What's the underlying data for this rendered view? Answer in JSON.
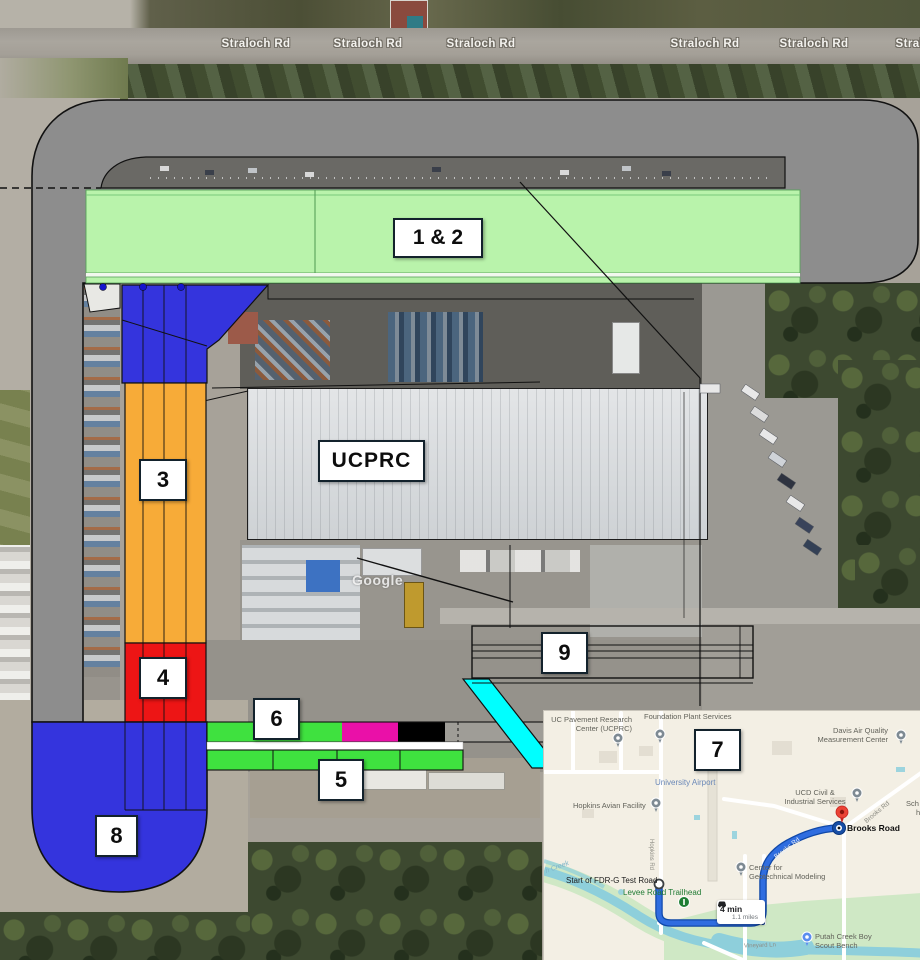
{
  "map_labels": {
    "road_name": "Straloch Rd",
    "road_labels": [
      "Straloch Rd",
      "Straloch Rd",
      "Straloch Rd",
      "Straloch Rd",
      "Straloch Rd",
      "Straloch Rd"
    ],
    "watermark": "Google"
  },
  "zones": {
    "z12": "1 & 2",
    "z3": "3",
    "z4": "4",
    "z5": "5",
    "z6": "6",
    "z7": "7",
    "z8": "8",
    "z9": "9",
    "building": "UCPRC"
  },
  "colors": {
    "track_gray": "#8d8d8d",
    "zone12_green": "#b9f3ab",
    "strip_green": "#3fe13f",
    "zone3_orange": "#f7ab38",
    "zone4_red": "#ed1515",
    "zone8_blue": "#3434dd",
    "magenta": "#ea10a8",
    "cyan": "#00ffff",
    "route_blue": "#2f6de0"
  },
  "inset": {
    "zone_label": "7",
    "trip": {
      "duration": "4 min",
      "distance": "1.1 miles"
    },
    "places": {
      "ucprc1": "UC Pavement Research",
      "ucprc2": "Center (UCPRC)",
      "foundation": "Foundation Plant Services",
      "davis1": "Davis Air Quality",
      "davis2": "Measurement Center",
      "airport": "University Airport",
      "hopkins": "Hopkins Avian Facility",
      "hopkins_rd": "Hopkins Rd",
      "ucd1": "UCD Civil &",
      "ucd2": "Industrial Services",
      "brooks_dest": "Brooks Road",
      "brooks_rd": "Brooks Rd",
      "sch": "Sch",
      "h": "h",
      "geo1": "Center for",
      "geo2": "Geotechnical Modeling",
      "putah1": "Putah Creek Boy",
      "putah2": "Scout Bench",
      "fdr": "Start of FDR-G Test Road",
      "levee": "Levee Road Trailhead",
      "vineyard": "Vineyard Ln",
      "creek": "h Creek"
    }
  }
}
